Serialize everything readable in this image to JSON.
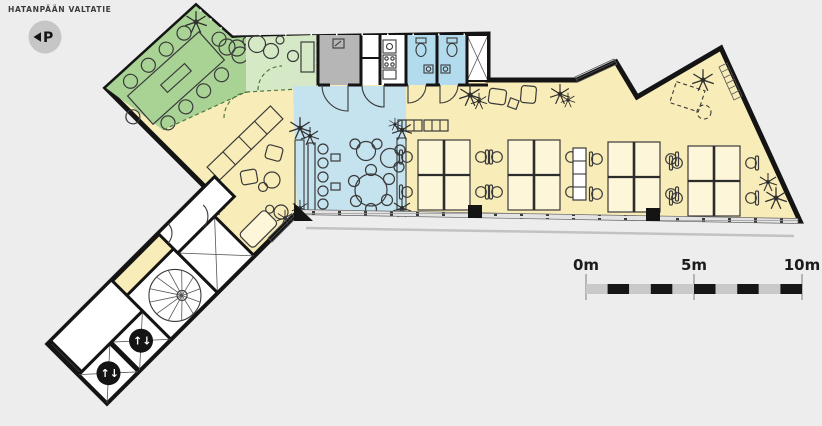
{
  "street_label": "HATANPÄÄN VALTATIE",
  "parking_badge": {
    "label": "P",
    "direction_icon": "left-triangle"
  },
  "scale_bar": {
    "unit": "m",
    "total_m": 10,
    "segment_m": 1,
    "ticks": [
      {
        "m": 0,
        "label": "0m"
      },
      {
        "m": 5,
        "label": "5m"
      },
      {
        "m": 10,
        "label": "10m"
      }
    ]
  },
  "wing": {
    "elevator_symbol": "↑↓",
    "elevator_count": 2,
    "stair_type": "spiral"
  },
  "colors": {
    "bg": "#ededed",
    "wall": "#141414",
    "floor_yellow": "#f8ecb8",
    "meeting_green": "#a8d395",
    "flex_green": "#d6e9c6",
    "cafe_blue": "#c5e2ef",
    "wc_blue": "#b2dcee",
    "tech_gray": "#b6b6b6",
    "room_white": "#ffffff",
    "window_gray": "#e3e3e3",
    "scale_gray": "#c9c9c9",
    "scale_black": "#161616",
    "badge_gray": "#c6c6c6"
  }
}
